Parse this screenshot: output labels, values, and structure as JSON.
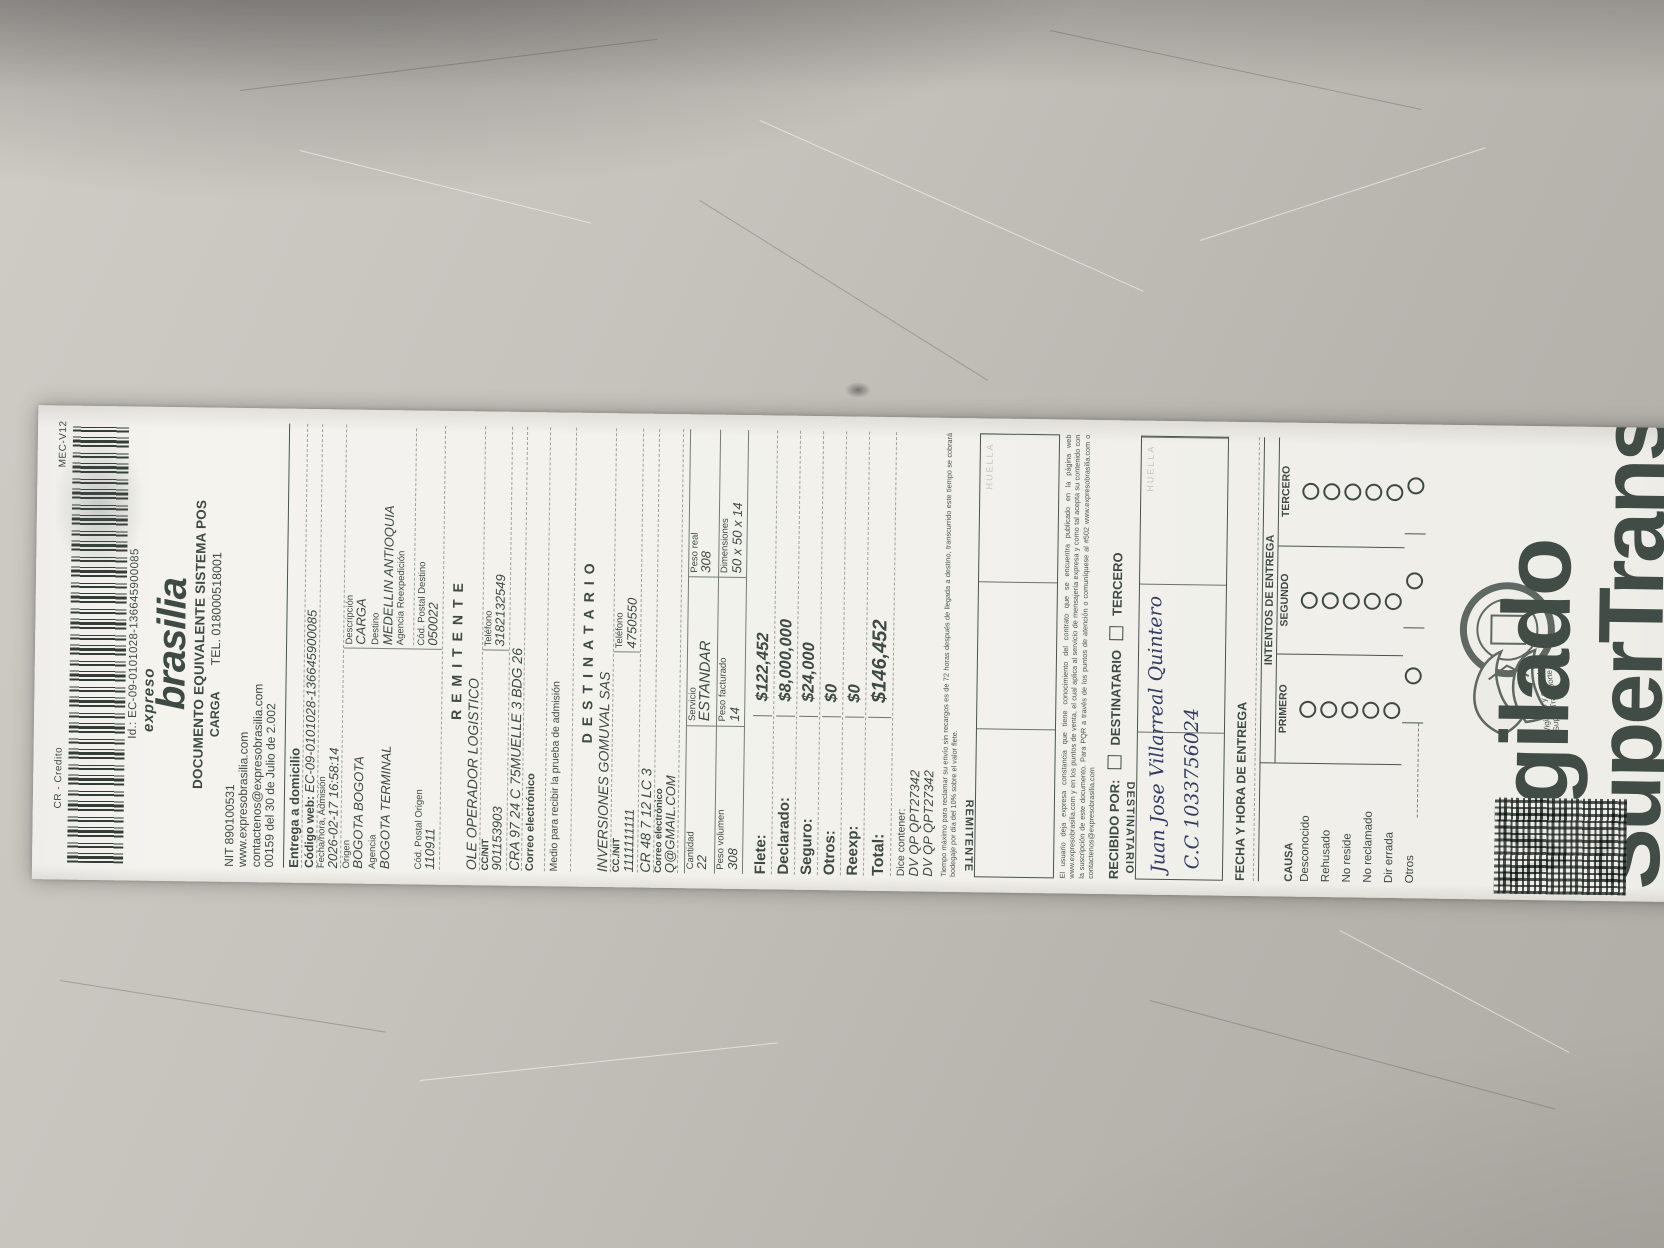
{
  "colors": {
    "print": "#3f4a44",
    "pen": "#333a63",
    "paper": "#f2f1ec",
    "desk": "#bdbab4"
  },
  "meta": {
    "cr": "CR - Credito",
    "mec": "MEC-V12",
    "id_line": "Id.: EC-09-0101028-136645900085"
  },
  "header": {
    "brand_script": "expreso",
    "brand": "brasilia",
    "doc_title": "DOCUMENTO EQUIVALENTE SISTEMA POS",
    "doc_subtitle": "CARGA",
    "tel": "TEL. 018000518001",
    "nit": "NIT 890100531",
    "web": "www.expresobrasilia.com",
    "email": "contactenos@expresobrasilia.com",
    "res": "00159 del 30 de Julio de 2.002"
  },
  "delivery": {
    "title": "Entrega a domicilio",
    "codigo_web_label": "Código web:",
    "codigo_web": "EC-09-0101028-136645900085",
    "fecha_label": "Fecha/hora, Admisión",
    "fecha": "2026-02-17 16:58:14",
    "origen_label": "Origen",
    "origen": "BOGOTA BOGOTA",
    "descripcion_label": "Descripción",
    "descripcion": "CARGA",
    "agencia_label": "Agencia",
    "agencia": "BOGOTA TERMINAL",
    "destino_label": "Destino",
    "destino": "MEDELLIN ANTIOQUIA",
    "reexp_label": "Agencia Reexpedición",
    "cod_origen_label": "Cód. Postal Origen",
    "cod_origen": "110911",
    "cod_destino_label": "Cód. Postal Destino",
    "cod_destino": "050022"
  },
  "remitente": {
    "title": "REMITENTE",
    "name": "OLE OPERADOR LOGISTICO",
    "cc_label": "CC/NIT",
    "cc": "901153903",
    "tel_label": "Teléfono",
    "tel": "3182132549",
    "addr": "CRA 97 24 C 75MUELLE 3 BDG 26",
    "correo_label": "Correo electrónico",
    "medio_label": "Medio para recibir la prueba de admisión"
  },
  "destinatario": {
    "title": "DESTINATARIO",
    "name": "INVERSIONES GOMUVAL SAS",
    "cc_label": "CC./NIT",
    "cc": "1111111111",
    "tel_label": "Teléfono",
    "tel": "4750550",
    "addr": "CR 48 7 12 LC 3",
    "correo_label": "Correo electrónico",
    "correo": "Q@GMAIL.COM"
  },
  "shipment": {
    "r1": [
      {
        "label": "Cantidad",
        "value": "22"
      },
      {
        "label": "Servicio",
        "value": "ESTANDAR"
      },
      {
        "label": "Peso real",
        "value": "308"
      }
    ],
    "r2": [
      {
        "label": "Peso volumen",
        "value": "308"
      },
      {
        "label": "Peso facturado",
        "value": "14"
      },
      {
        "label": "Dimensiones",
        "value": "50 x 50 x 14"
      }
    ]
  },
  "charges": {
    "rows": [
      {
        "label": "Flete:",
        "value": "$122,452"
      },
      {
        "label": "Declarado:",
        "value": "$8,000,000"
      },
      {
        "label": "Seguro:",
        "value": "$24,000"
      },
      {
        "label": "Otros:",
        "value": "$0"
      },
      {
        "label": "Reexp:",
        "value": "$0"
      },
      {
        "label": "Total:",
        "value": "$146,452"
      }
    ]
  },
  "dice": {
    "label": "Dice contener:",
    "l1": "DV QP   QPT27342",
    "l2": "DV QP   QPT27342"
  },
  "legal": {
    "p1": "Tiempo máximo para reclamar su envío sin recargos es de 72 horas después de llegada a destino, transcurrido este tiempo se cobrará bodegaje por día del 10% sobre el valor flete.",
    "p2": "El usuario deja expresa constancia que tiene conocimiento del contrato que se encuentra publicado en la página web www.expresobrasilia.com y en los puntos de venta, el cual aplica al servicio de mensajería expresa y como tal acepta su contenido con la suscripción de este documento. Para PQR a través de los puntos de atención o comuníquese al #502 www.expresobrasilia.com  o  contactenos@expresobrasilia.com"
  },
  "recibido": {
    "label": "RECIBIDO POR:",
    "opt1": "DESTINATARIO",
    "opt2": "TERCERO"
  },
  "sign_remitente": {
    "label": "REMITENTE",
    "huella": "HUELLA"
  },
  "sign_destinatario": {
    "label": "DESTINATARIO",
    "huella": "HUELLA",
    "nombre_hand": "Juan Jose Villarreal Quintero",
    "cc_hand": "C.C 1033756024"
  },
  "entrega": {
    "fecha_title": "FECHA Y HORA DE ENTREGA",
    "intentos_title": "INTENTOS DE ENTREGA",
    "cols": [
      "PRIMERO",
      "SEGUNDO",
      "TERCERO"
    ],
    "causa_label": "CAUSA",
    "causas": [
      "Desconocido",
      "Rehusado",
      "No reside",
      "No reclamado",
      "Dir errada",
      "Otros"
    ]
  },
  "footer": {
    "big1": "Vigilado",
    "big2": "SuperTransporte",
    "small": "Vigilado y controlado Super Transporte"
  }
}
